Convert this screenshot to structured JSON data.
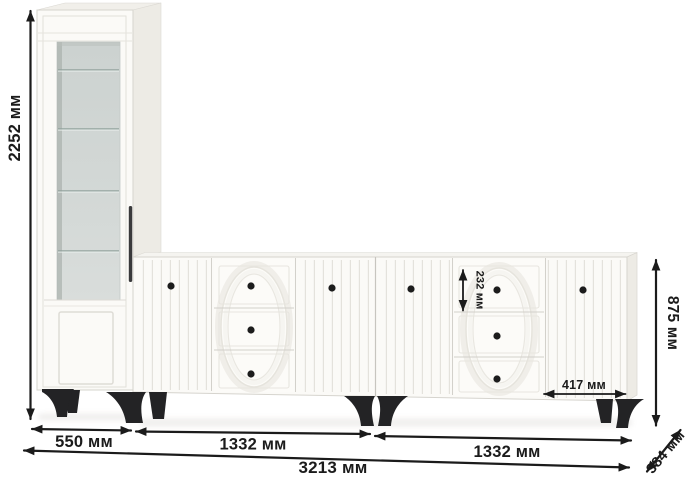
{
  "diagram": {
    "kind": "furniture dimension drawing",
    "unit_label": "мм"
  },
  "dimensions": {
    "total_height": "2252 мм",
    "cabinet_width": "550 мм",
    "left_sideboard_width": "1332 мм",
    "right_sideboard_width": "1332 мм",
    "total_width": "3213 мм",
    "depth": "384 мм",
    "sideboard_height": "875 мм",
    "top_drawer_height": "232 мм",
    "door_width": "417 мм"
  },
  "colors": {
    "dimension": "#1b1b1b",
    "legs": "#232325",
    "knobs": "#1c1c1c",
    "handle": "#3a3a3c",
    "body": "#fbfaf7",
    "body_side": "#edebe5",
    "body_top": "#f1efea",
    "glass": "#d3d8d6",
    "outline": "#d6d4ce",
    "background": "#ffffff"
  }
}
